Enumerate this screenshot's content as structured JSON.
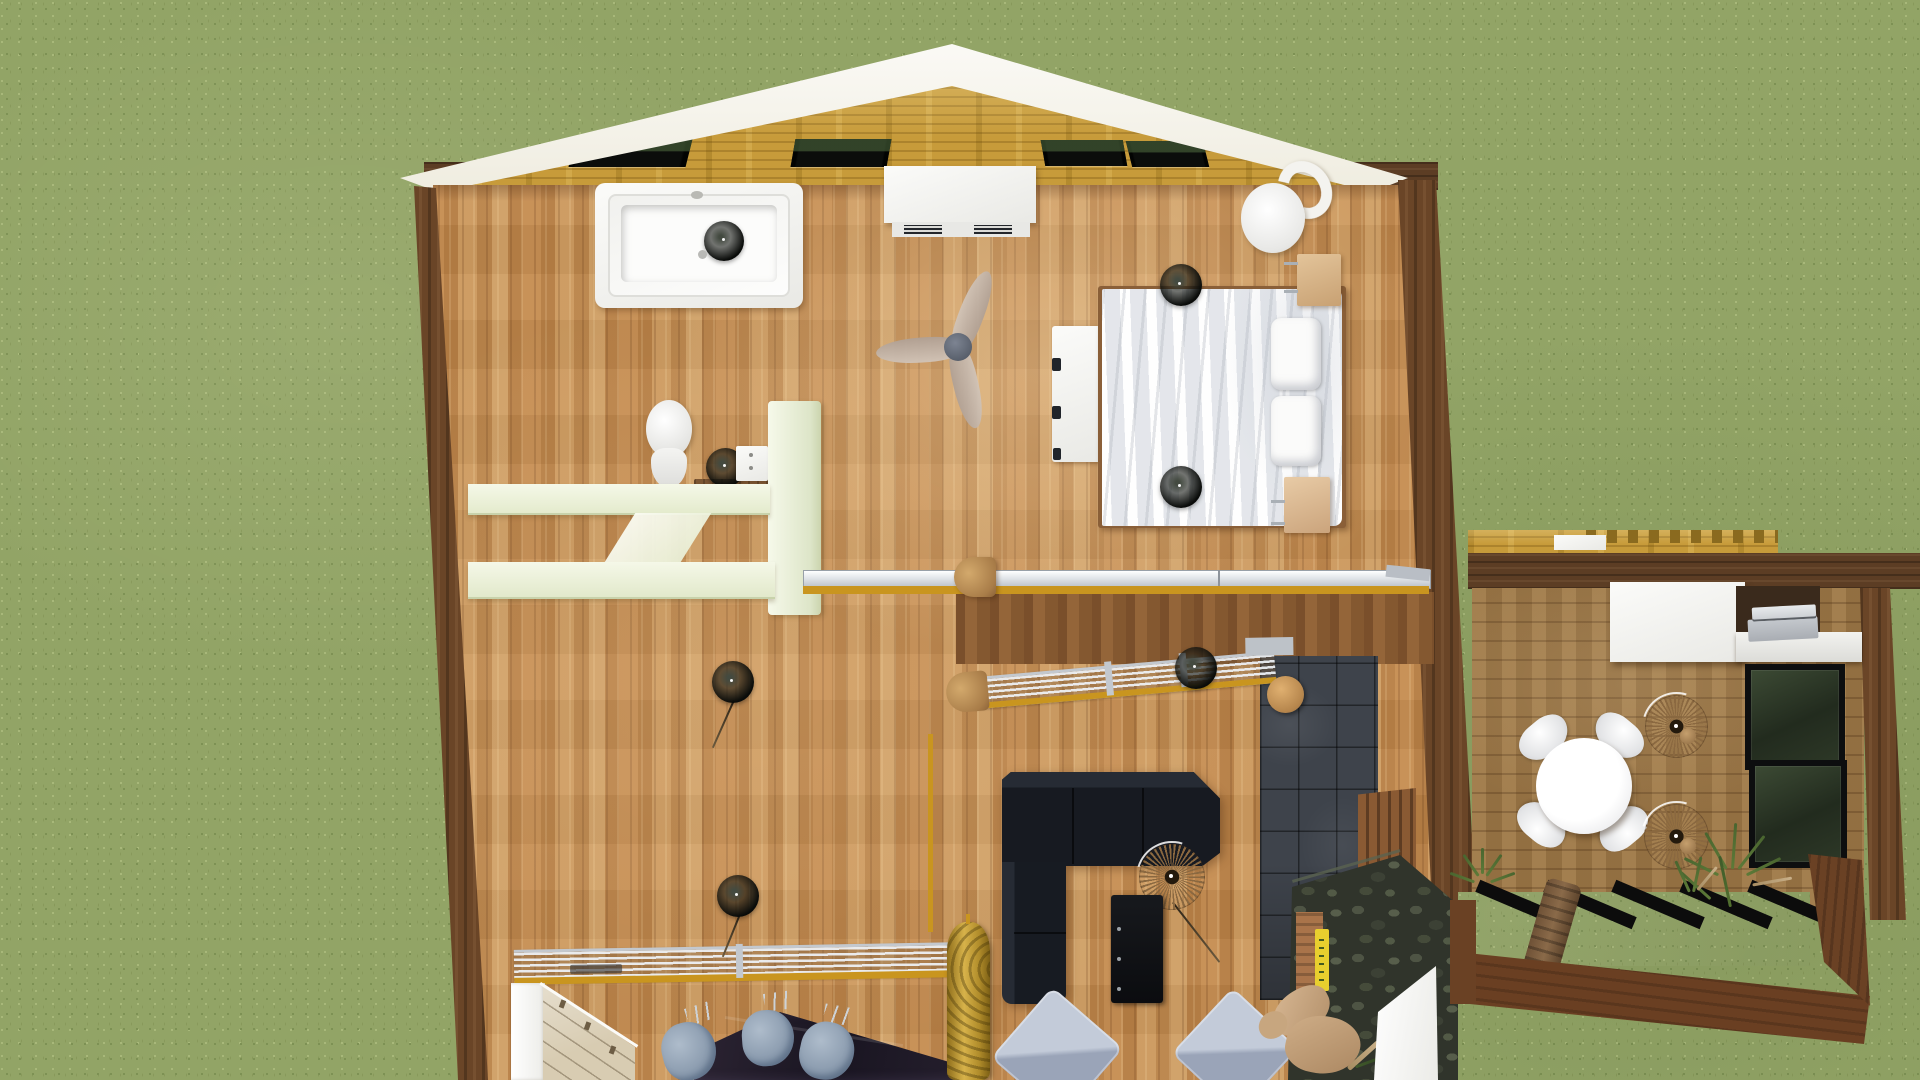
{
  "colors": {
    "grass_base": "#92a466",
    "grass_dark": "#7d9154",
    "grass_light": "#a8b87a",
    "floor_mid": "#c28b51",
    "deck_floor": "#9b7747",
    "wall_dark": "#6a4527",
    "roof_gold": "#c79b3a",
    "accent_gold": "#c9951f",
    "tile_dark": "#3e434b",
    "stone": "#30342b",
    "fascia_white": "#f6f4ed",
    "sofa_dark": "#171a21",
    "mint_shelf": "#eef3dc",
    "chair_gray": "#93a2b4"
  },
  "scene": {
    "environment": "grass-lawn",
    "view": "top-down-3d-floor-plan",
    "skylight_count": 4,
    "ceiling_light_count": 6,
    "rooms": [
      {
        "name": "bathroom",
        "items": [
          "bathtub",
          "toilet",
          "vessel-sink",
          "sink-console",
          "shelf-partition",
          "ceiling-light"
        ]
      },
      {
        "name": "bedroom",
        "items": [
          "double-bed",
          "pillows",
          "bedside-bench",
          "nightstand",
          "nightstand",
          "round-armchair",
          "ceiling-fan",
          "wall-cabinet",
          "ceiling-light",
          "ceiling-light"
        ]
      },
      {
        "name": "loft-landing",
        "items": [
          "glass-railing",
          "slatted-railing",
          "stair-treads",
          "newel-post",
          "tile-chimney-wall",
          "pendant-light"
        ]
      },
      {
        "name": "living-kitchen",
        "items": [
          "corner-sofa",
          "rattan-pendant-lamp",
          "media-cabinet",
          "floor-cushion",
          "floor-cushion",
          "kitchen-counter",
          "bar-chair",
          "bar-chair",
          "bar-chair",
          "glass-dining-table",
          "pendant-light",
          "pendant-light",
          "carved-wood-pillar",
          "stone-counter",
          "yellow-book",
          "dried-plant",
          "white-partition"
        ]
      },
      {
        "name": "patio-deck",
        "items": [
          "round-dining-table",
          "patio-chair",
          "patio-chair",
          "patio-chair",
          "patio-chair",
          "rattan-pendant-lamp",
          "rattan-pendant-lamp",
          "wall-desk",
          "laptop",
          "glass-door-panel",
          "glass-door-panel",
          "ornamental-grass",
          "ornamental-grass",
          "pergola-joists",
          "driftwood-plank"
        ]
      }
    ]
  }
}
